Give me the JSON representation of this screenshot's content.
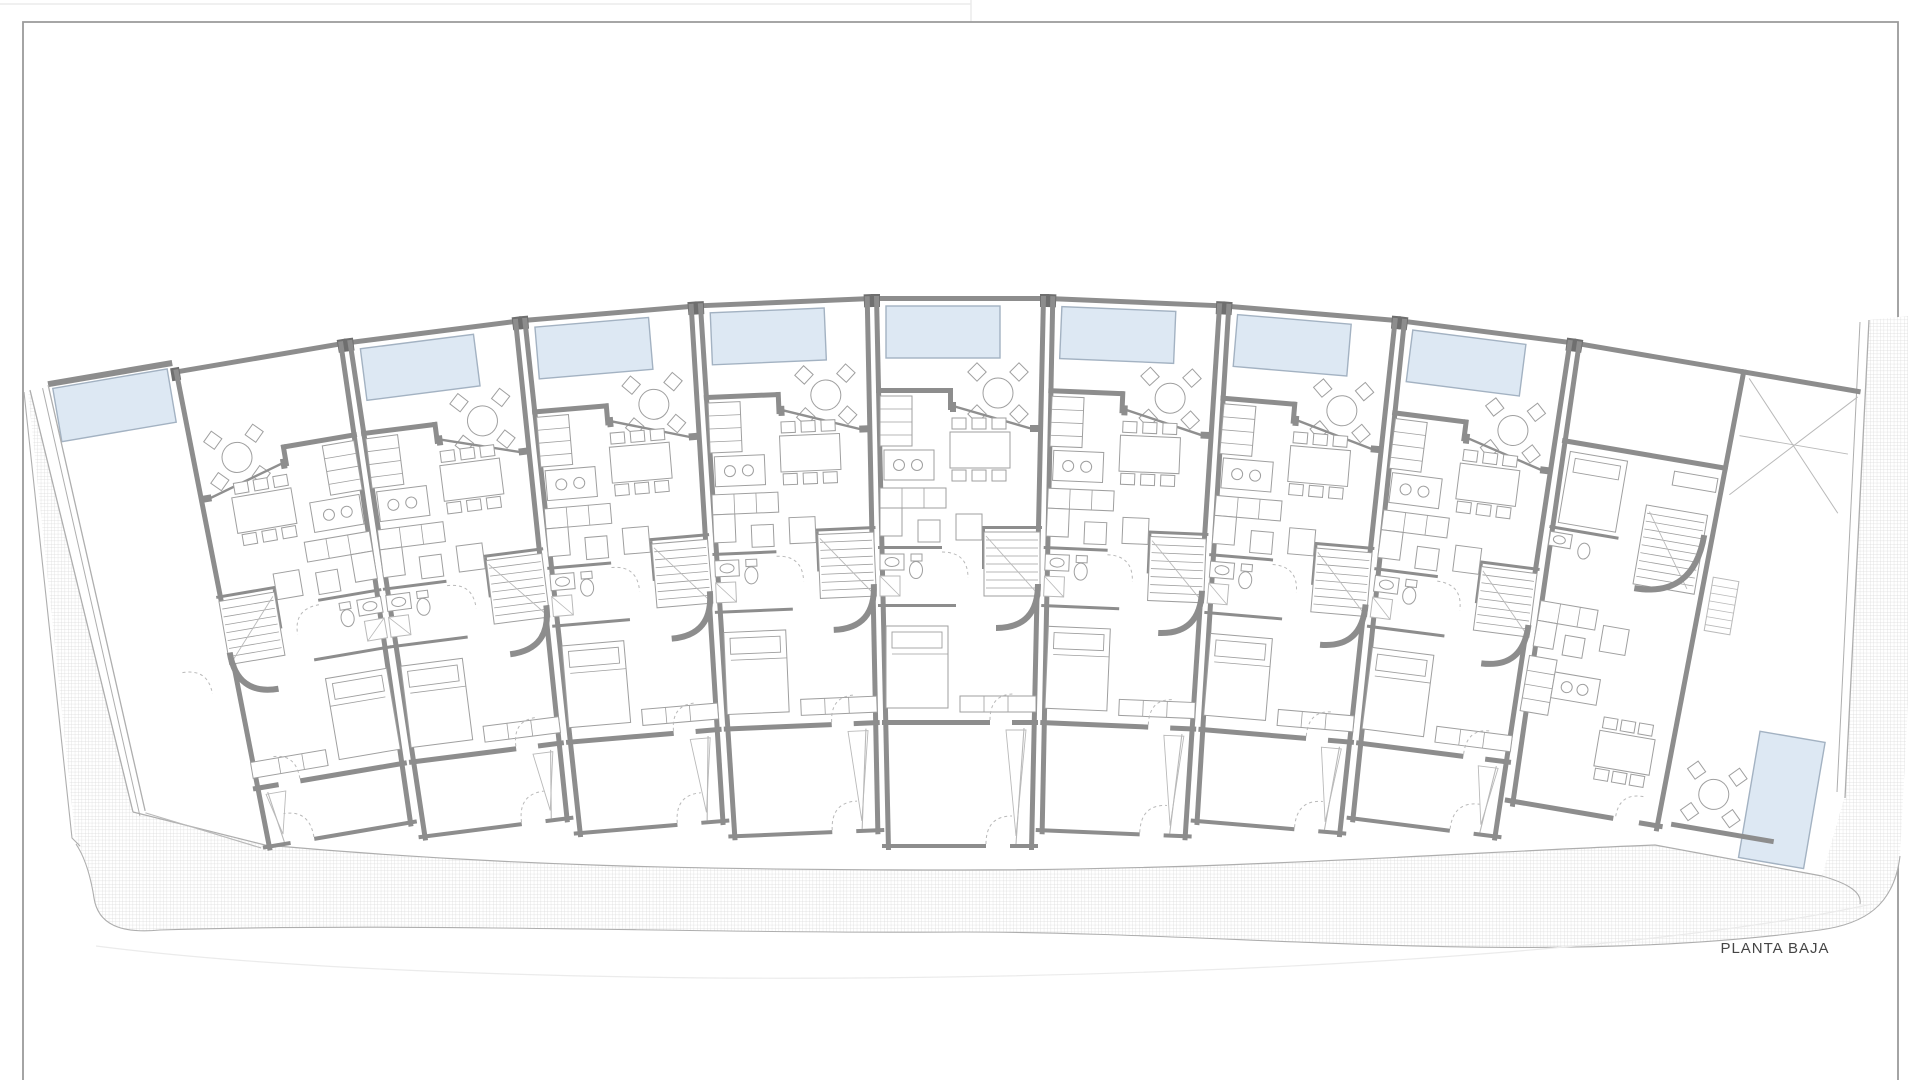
{
  "page": {
    "sheet_label": "PLANTA BAJA"
  },
  "colors": {
    "wall": "#8d8d8d",
    "wall_dark": "#6f6f6f",
    "furniture_line": "#9f9f9f",
    "light_line": "#b9b9b9",
    "boundary_line": "#aeaeae",
    "pool_fill": "#dde8f3",
    "pool_stroke": "#a3b2c2",
    "hatch_line": "#d6d6d6",
    "frame": "#9a9a9a",
    "faint": "#ebebeb",
    "text": "#454545"
  },
  "site": {
    "units_count": 9,
    "fan_step_deg": 2.42,
    "pivot": [
      960,
      4470
    ],
    "unit_width": 176,
    "unit_top_y": 296
  },
  "units": [
    {
      "id": "unit-1",
      "pool": "garden-left",
      "mirrored": true,
      "end": "left"
    },
    {
      "id": "unit-2",
      "pool": "terrace-top",
      "mirrored": false,
      "end": null
    },
    {
      "id": "unit-3",
      "pool": "terrace-top",
      "mirrored": false,
      "end": null
    },
    {
      "id": "unit-4",
      "pool": "terrace-top",
      "mirrored": false,
      "end": null
    },
    {
      "id": "unit-5",
      "pool": "terrace-top",
      "mirrored": false,
      "end": null
    },
    {
      "id": "unit-6",
      "pool": "terrace-top",
      "mirrored": false,
      "end": null
    },
    {
      "id": "unit-7",
      "pool": "terrace-top",
      "mirrored": false,
      "end": null
    },
    {
      "id": "unit-8",
      "pool": "terrace-top",
      "mirrored": false,
      "end": null
    },
    {
      "id": "unit-9",
      "pool": "garden-bottom-right",
      "mirrored": false,
      "end": "right"
    }
  ]
}
